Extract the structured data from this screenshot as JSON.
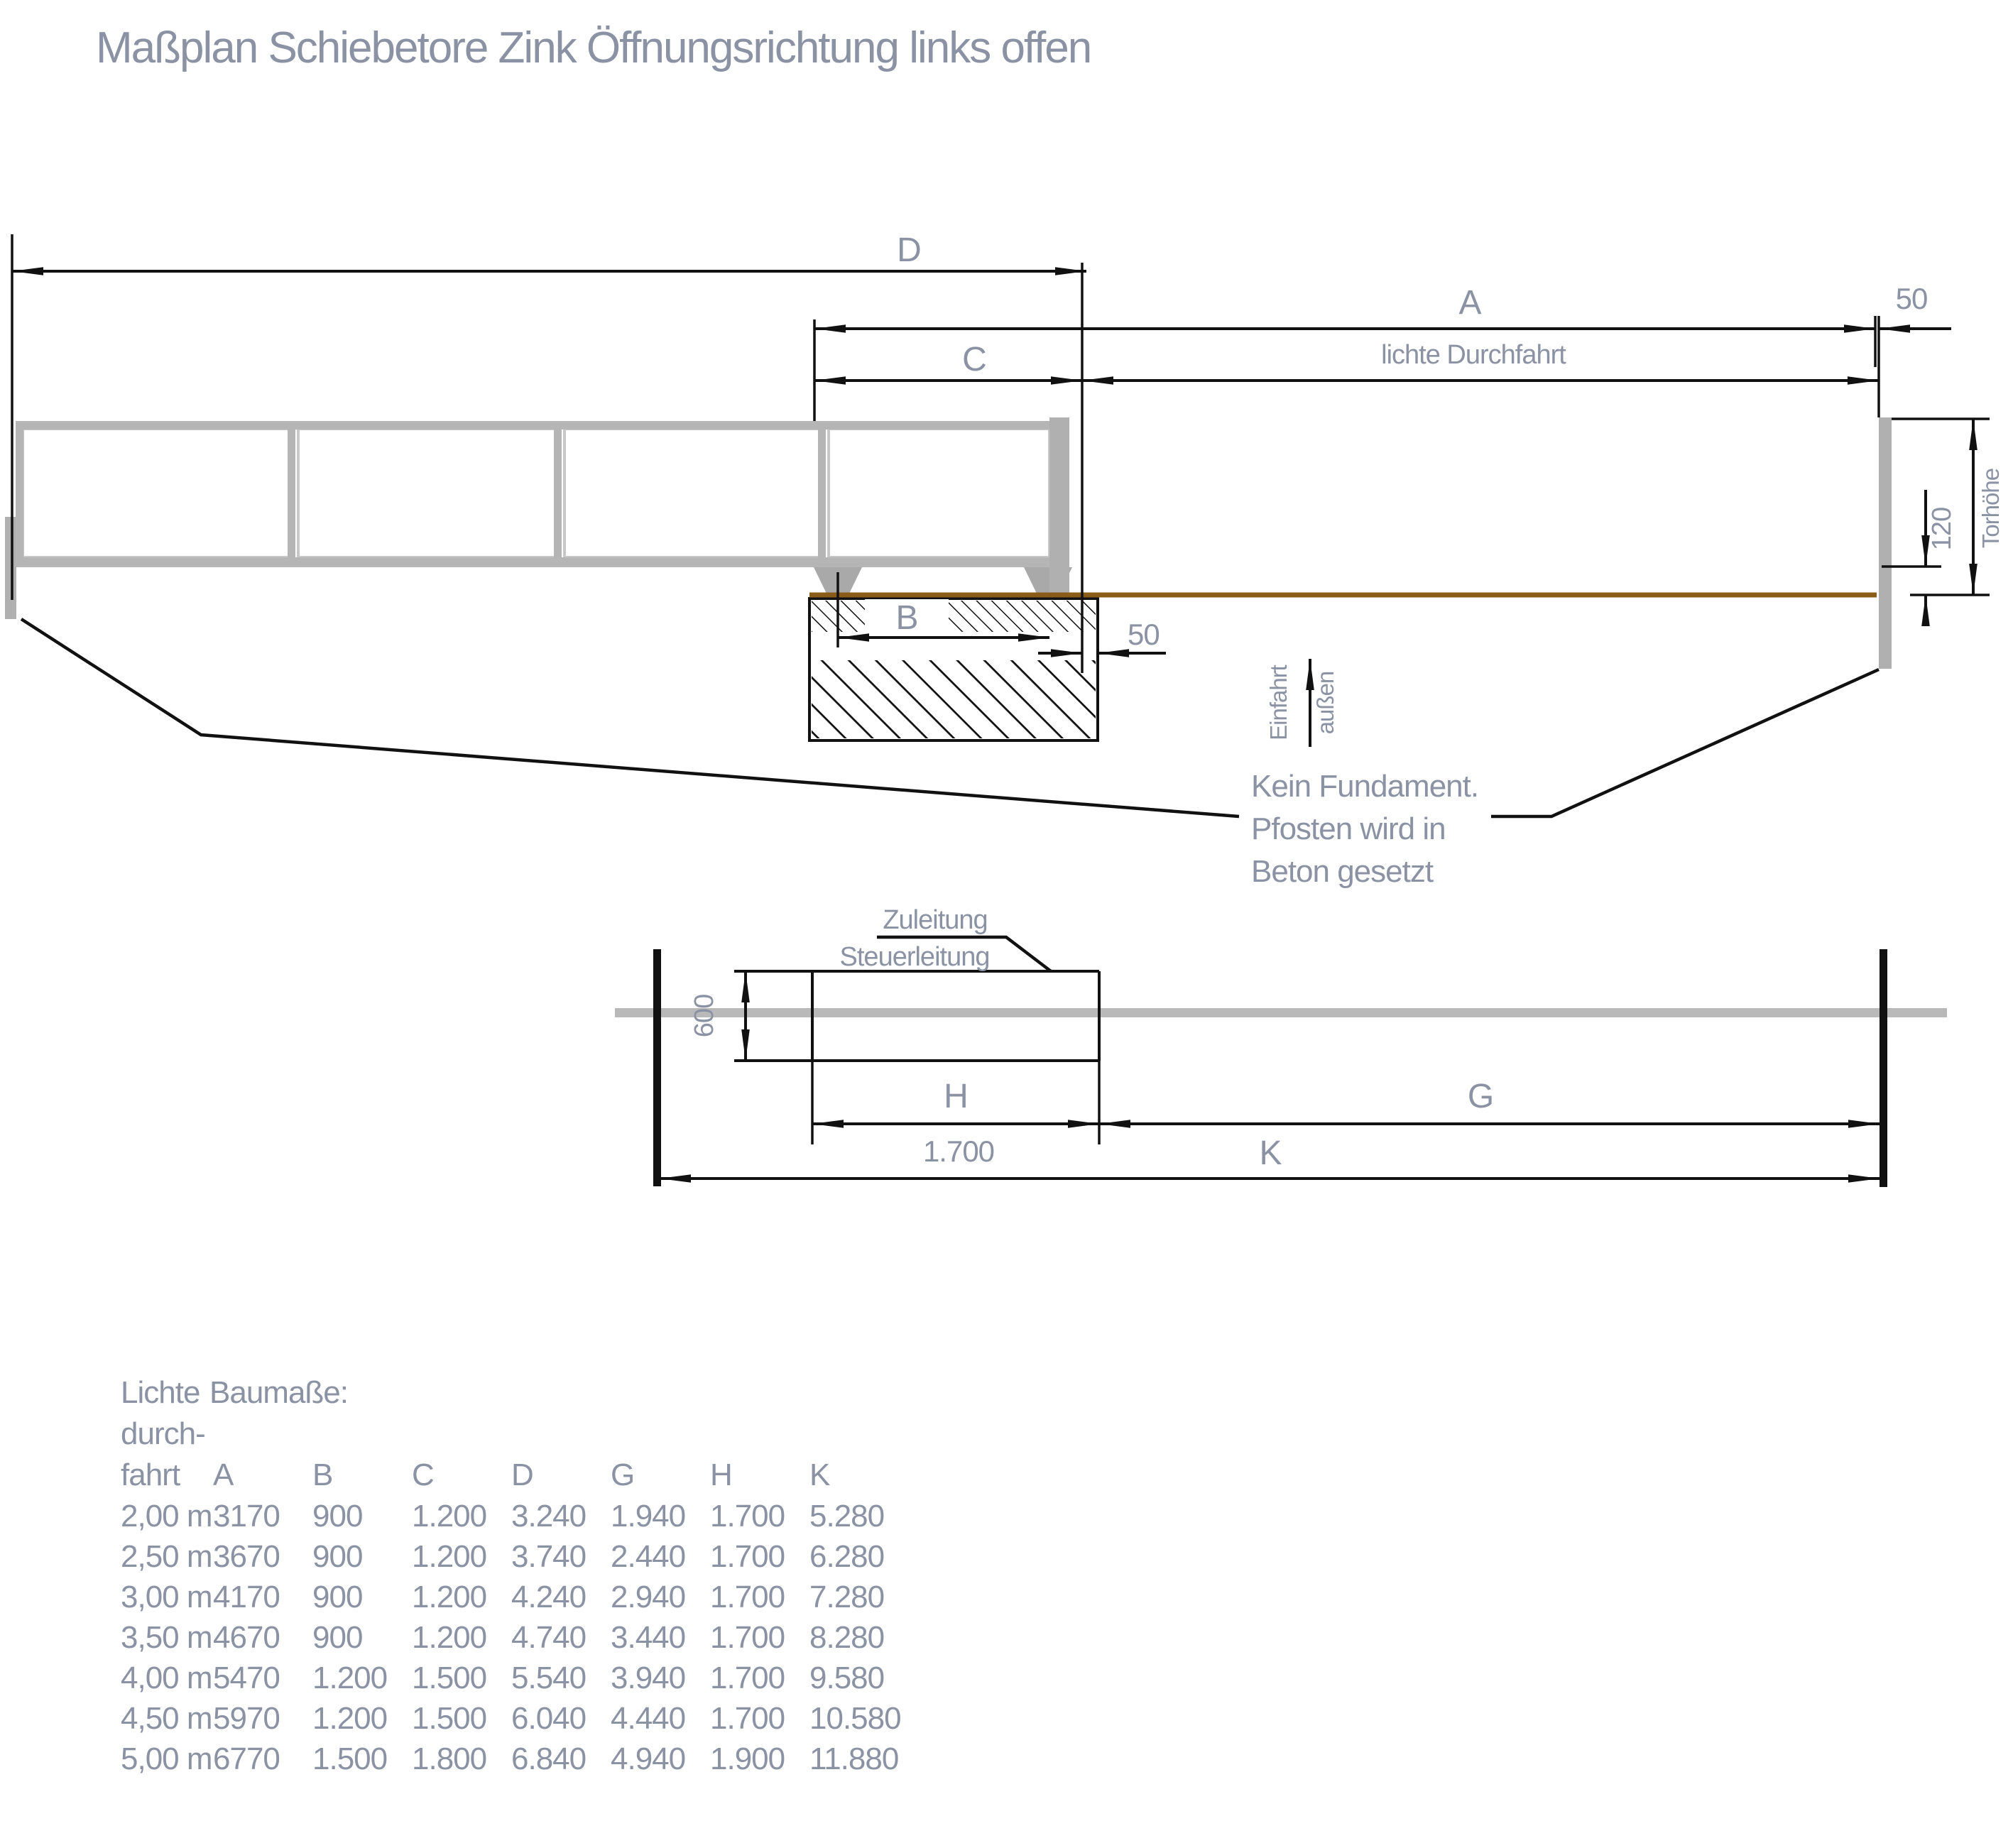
{
  "title": "Maßplan Schiebetore Zink Öffnungsrichtung links offen",
  "colors": {
    "text": "#8b92a3",
    "line": "#111111",
    "gate_gray": "#b5b5b5",
    "gate_dark": "#a9a9a9",
    "ground_brown": "#8a5c1a"
  },
  "elevation": {
    "dim_d": "D",
    "dim_a": "A",
    "dim_c": "C",
    "dim_b": "B",
    "dim_50_post": "50",
    "dim_50_foundation": "50",
    "dim_120": "120",
    "gate_height": "Torhöhe",
    "clear_passage": "lichte Durchfahrt",
    "drive_in": "Einfahrt",
    "outside": "außen",
    "note_line1": "Kein Fundament.",
    "note_line2": "Pfosten wird in",
    "note_line3": "Beton gesetzt"
  },
  "plan": {
    "supply_line": "Zuleitung",
    "control_line": "Steuerleitung",
    "dim_600": "600",
    "dim_h": "H",
    "dim_g": "G",
    "dim_k": "K",
    "dim_1700": "1.700"
  },
  "table": {
    "col1_line1": "Lichte",
    "col1_line2": "durch-",
    "col1_line3": "fahrt",
    "group_header": "Baumaße:",
    "columns": [
      "A",
      "B",
      "C",
      "D",
      "G",
      "H",
      "K"
    ],
    "rows": [
      [
        "2,00 m",
        "3170",
        "900",
        "1.200",
        "3.240",
        "1.940",
        "1.700",
        "5.280"
      ],
      [
        "2,50 m",
        "3670",
        "900",
        "1.200",
        "3.740",
        "2.440",
        "1.700",
        "6.280"
      ],
      [
        "3,00 m",
        "4170",
        "900",
        "1.200",
        "4.240",
        "2.940",
        "1.700",
        "7.280"
      ],
      [
        "3,50 m",
        "4670",
        "900",
        "1.200",
        "4.740",
        "3.440",
        "1.700",
        "8.280"
      ],
      [
        "4,00 m",
        "5470",
        "1.200",
        "1.500",
        "5.540",
        "3.940",
        "1.700",
        "9.580"
      ],
      [
        "4,50 m",
        "5970",
        "1.200",
        "1.500",
        "6.040",
        "4.440",
        "1.700",
        "10.580"
      ],
      [
        "5,00 m",
        "6770",
        "1.500",
        "1.800",
        "6.840",
        "4.940",
        "1.900",
        "11.880"
      ]
    ]
  }
}
